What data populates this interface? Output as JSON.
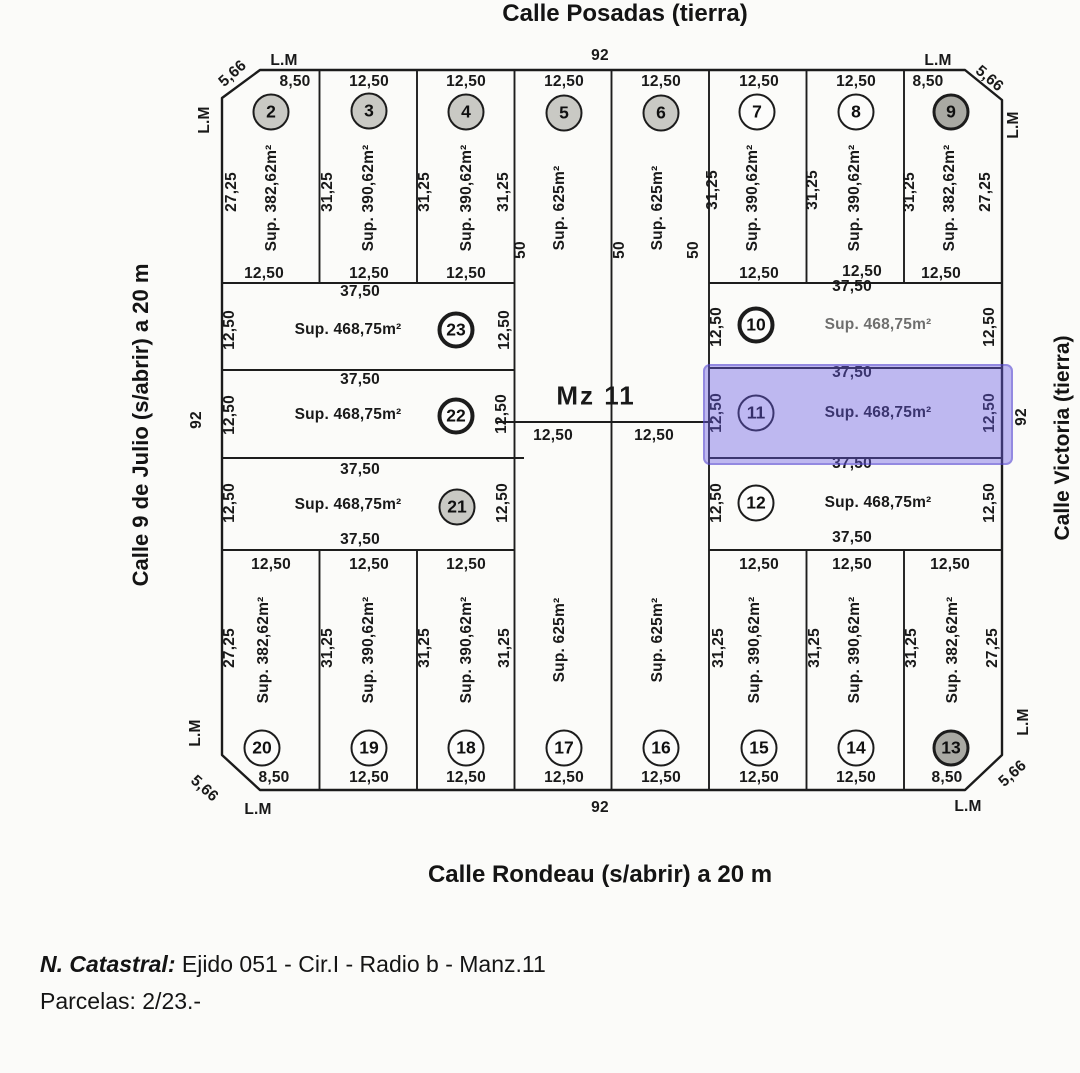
{
  "streets": {
    "top": "Calle Posadas (tierra)",
    "left": "Calle 9 de Julio (s/abrir) a 20 m",
    "right": "Calle Victoria (tierra)",
    "bottom": "Calle Rondeau (s/abrir) a 20 m"
  },
  "notes": {
    "catastral_label": "N. Catastral:",
    "catastral_value": "Ejido 051 - Cir.I - Radio b - Manz.11",
    "parcelas": "Parcelas: 2/23.-"
  },
  "block_label": "Mz 11",
  "colors": {
    "highlight": "#685ae4",
    "line": "#1d1d1d",
    "paper": "#fbfbf9"
  },
  "plan": {
    "outline": "M 260 70 L 965 70 L 1002 100 L 1002 755 L 965 790 L 260 790 L 222 755 L 222 98 Z",
    "lines": [
      [
        319.5,
        70,
        319.5,
        283
      ],
      [
        417,
        70,
        417,
        283
      ],
      [
        806.5,
        70,
        806.5,
        283
      ],
      [
        904,
        70,
        904,
        283
      ],
      [
        319.5,
        550,
        319.5,
        790
      ],
      [
        417,
        550,
        417,
        790
      ],
      [
        806.5,
        550,
        806.5,
        790
      ],
      [
        904,
        550,
        904,
        790
      ],
      [
        514.5,
        70,
        514.5,
        790
      ],
      [
        611.5,
        70,
        611.5,
        790
      ],
      [
        709,
        70,
        709,
        790
      ],
      [
        222,
        283,
        514.5,
        283
      ],
      [
        709,
        283,
        1002,
        283
      ],
      [
        222,
        370,
        514.5,
        370
      ],
      [
        709,
        368,
        1002,
        368
      ],
      [
        222,
        458,
        524,
        458
      ],
      [
        709,
        458,
        1002,
        458
      ],
      [
        222,
        550,
        514.5,
        550
      ],
      [
        709,
        550,
        1002,
        550
      ],
      [
        496,
        422,
        712,
        422
      ]
    ],
    "highlight": {
      "x": 703,
      "y": 364,
      "w": 306,
      "h": 97,
      "parcel": "11"
    },
    "labels": [
      {
        "t": "92",
        "x": 600,
        "y": 56
      },
      {
        "t": "L.M",
        "x": 284,
        "y": 61
      },
      {
        "t": "5,66",
        "x": 233,
        "y": 74,
        "r": -42
      },
      {
        "t": "L.M",
        "x": 205,
        "y": 120,
        "r": -90
      },
      {
        "t": "L.M",
        "x": 938,
        "y": 61
      },
      {
        "t": "5,66",
        "x": 989,
        "y": 79,
        "r": 40
      },
      {
        "t": "L.M",
        "x": 1014,
        "y": 125,
        "r": -90
      },
      {
        "t": "92",
        "x": 197,
        "y": 420,
        "r": -90
      },
      {
        "t": "92",
        "x": 1022,
        "y": 417,
        "r": -90
      },
      {
        "t": "92",
        "x": 600,
        "y": 808
      },
      {
        "t": "L.M",
        "x": 258,
        "y": 810
      },
      {
        "t": "5,66",
        "x": 204,
        "y": 789,
        "r": 42
      },
      {
        "t": "L.M",
        "x": 196,
        "y": 733,
        "r": -90
      },
      {
        "t": "L.M",
        "x": 968,
        "y": 807
      },
      {
        "t": "5,66",
        "x": 1013,
        "y": 774,
        "r": -42
      },
      {
        "t": "L.M",
        "x": 1024,
        "y": 722,
        "r": -90
      },
      {
        "t": "8,50",
        "x": 295,
        "y": 82
      },
      {
        "t": "12,50",
        "x": 369,
        "y": 82
      },
      {
        "t": "12,50",
        "x": 466,
        "y": 82
      },
      {
        "t": "12,50",
        "x": 564,
        "y": 82
      },
      {
        "t": "12,50",
        "x": 661,
        "y": 82
      },
      {
        "t": "12,50",
        "x": 759,
        "y": 82
      },
      {
        "t": "12,50",
        "x": 856,
        "y": 82
      },
      {
        "t": "8,50",
        "x": 928,
        "y": 82
      },
      {
        "t": "12,50",
        "x": 264,
        "y": 274
      },
      {
        "t": "12,50",
        "x": 369,
        "y": 274
      },
      {
        "t": "12,50",
        "x": 466,
        "y": 274
      },
      {
        "t": "12,50",
        "x": 759,
        "y": 274
      },
      {
        "t": "12,50",
        "x": 862,
        "y": 272
      },
      {
        "t": "12,50",
        "x": 941,
        "y": 274
      },
      {
        "t": "27,25",
        "x": 232,
        "y": 192,
        "r": -90
      },
      {
        "t": "31,25",
        "x": 328,
        "y": 192,
        "r": -90
      },
      {
        "t": "31,25",
        "x": 425,
        "y": 192,
        "r": -90
      },
      {
        "t": "31,25",
        "x": 504,
        "y": 192,
        "r": -90
      },
      {
        "t": "31,25",
        "x": 713,
        "y": 190,
        "r": -90
      },
      {
        "t": "31,25",
        "x": 813,
        "y": 190,
        "r": -90
      },
      {
        "t": "31,25",
        "x": 910,
        "y": 192,
        "r": -90
      },
      {
        "t": "27,25",
        "x": 986,
        "y": 192,
        "r": -90
      },
      {
        "t": "50",
        "x": 521,
        "y": 250,
        "r": -90
      },
      {
        "t": "50",
        "x": 620,
        "y": 250,
        "r": -90
      },
      {
        "t": "50",
        "x": 694,
        "y": 250,
        "r": -90
      },
      {
        "t": "37,50",
        "x": 360,
        "y": 292
      },
      {
        "t": "37,50",
        "x": 360,
        "y": 380
      },
      {
        "t": "37,50",
        "x": 360,
        "y": 470
      },
      {
        "t": "37,50",
        "x": 360,
        "y": 540
      },
      {
        "t": "37,50",
        "x": 852,
        "y": 287
      },
      {
        "t": "37,50",
        "x": 852,
        "y": 373
      },
      {
        "t": "37,50",
        "x": 852,
        "y": 464
      },
      {
        "t": "37,50",
        "x": 852,
        "y": 538
      },
      {
        "t": "12,50",
        "x": 230,
        "y": 330,
        "r": -90
      },
      {
        "t": "12,50",
        "x": 505,
        "y": 330,
        "r": -90
      },
      {
        "t": "12,50",
        "x": 230,
        "y": 415,
        "r": -90
      },
      {
        "t": "12,50",
        "x": 502,
        "y": 414,
        "r": -90
      },
      {
        "t": "12,50",
        "x": 230,
        "y": 503,
        "r": -90
      },
      {
        "t": "12,50",
        "x": 503,
        "y": 503,
        "r": -90
      },
      {
        "t": "12,50",
        "x": 717,
        "y": 327,
        "r": -90
      },
      {
        "t": "12,50",
        "x": 990,
        "y": 327,
        "r": -90
      },
      {
        "t": "12,50",
        "x": 717,
        "y": 413,
        "r": -90
      },
      {
        "t": "12,50",
        "x": 990,
        "y": 413,
        "r": -90
      },
      {
        "t": "12,50",
        "x": 717,
        "y": 503,
        "r": -90
      },
      {
        "t": "12,50",
        "x": 990,
        "y": 503,
        "r": -90
      },
      {
        "t": "Mz 11",
        "x": 596,
        "y": 396,
        "s": "lg"
      },
      {
        "t": "12,50",
        "x": 553,
        "y": 436
      },
      {
        "t": "12,50",
        "x": 654,
        "y": 436
      },
      {
        "t": "12,50",
        "x": 271,
        "y": 565
      },
      {
        "t": "12,50",
        "x": 369,
        "y": 565
      },
      {
        "t": "12,50",
        "x": 466,
        "y": 565
      },
      {
        "t": "12,50",
        "x": 759,
        "y": 565
      },
      {
        "t": "12,50",
        "x": 852,
        "y": 565
      },
      {
        "t": "12,50",
        "x": 950,
        "y": 565
      },
      {
        "t": "27,25",
        "x": 230,
        "y": 648,
        "r": -90
      },
      {
        "t": "31,25",
        "x": 328,
        "y": 648,
        "r": -90
      },
      {
        "t": "31,25",
        "x": 425,
        "y": 648,
        "r": -90
      },
      {
        "t": "31,25",
        "x": 505,
        "y": 648,
        "r": -90
      },
      {
        "t": "31,25",
        "x": 719,
        "y": 648,
        "r": -90
      },
      {
        "t": "31,25",
        "x": 815,
        "y": 648,
        "r": -90
      },
      {
        "t": "31,25",
        "x": 912,
        "y": 648,
        "r": -90
      },
      {
        "t": "27,25",
        "x": 993,
        "y": 648,
        "r": -90
      },
      {
        "t": "8,50",
        "x": 274,
        "y": 778
      },
      {
        "t": "12,50",
        "x": 369,
        "y": 778
      },
      {
        "t": "12,50",
        "x": 466,
        "y": 778
      },
      {
        "t": "12,50",
        "x": 564,
        "y": 778
      },
      {
        "t": "12,50",
        "x": 661,
        "y": 778
      },
      {
        "t": "12,50",
        "x": 759,
        "y": 778
      },
      {
        "t": "12,50",
        "x": 856,
        "y": 778
      },
      {
        "t": "8,50",
        "x": 947,
        "y": 778
      }
    ],
    "parcels": [
      {
        "num": "2",
        "cx": 271,
        "cy": 112,
        "style": "gray",
        "sup": {
          "t": "Sup. 382,62m²",
          "x": 272,
          "y": 198,
          "r": -90
        }
      },
      {
        "num": "3",
        "cx": 369,
        "cy": 111,
        "style": "gray",
        "sup": {
          "t": "Sup. 390,62m²",
          "x": 369,
          "y": 198,
          "r": -90
        }
      },
      {
        "num": "4",
        "cx": 466,
        "cy": 112,
        "style": "gray",
        "sup": {
          "t": "Sup. 390,62m²",
          "x": 467,
          "y": 198,
          "r": -90
        }
      },
      {
        "num": "5",
        "cx": 564,
        "cy": 113,
        "style": "gray",
        "sup": {
          "t": "Sup. 625m²",
          "x": 560,
          "y": 208,
          "r": -90
        }
      },
      {
        "num": "6",
        "cx": 661,
        "cy": 113,
        "style": "gray",
        "sup": {
          "t": "Sup. 625m²",
          "x": 658,
          "y": 208,
          "r": -90
        }
      },
      {
        "num": "7",
        "cx": 757,
        "cy": 112,
        "style": "normal",
        "sup": {
          "t": "Sup. 390,62m²",
          "x": 753,
          "y": 198,
          "r": -90
        }
      },
      {
        "num": "8",
        "cx": 856,
        "cy": 112,
        "style": "normal",
        "sup": {
          "t": "Sup. 390,62m²",
          "x": 855,
          "y": 198,
          "r": -90
        }
      },
      {
        "num": "9",
        "cx": 951,
        "cy": 112,
        "style": "dark",
        "sup": {
          "t": "Sup. 382,62m²",
          "x": 950,
          "y": 198,
          "r": -90
        }
      },
      {
        "num": "10",
        "cx": 756,
        "cy": 325,
        "style": "bold",
        "sup": {
          "t": "Sup. 468,75m²",
          "x": 878,
          "y": 325,
          "r": 0,
          "faded": true
        }
      },
      {
        "num": "11",
        "cx": 756,
        "cy": 413,
        "style": "normal",
        "sup": {
          "t": "Sup. 468,75m²",
          "x": 878,
          "y": 413,
          "r": 0
        }
      },
      {
        "num": "12",
        "cx": 756,
        "cy": 503,
        "style": "normal",
        "sup": {
          "t": "Sup. 468,75m²",
          "x": 878,
          "y": 503,
          "r": 0
        }
      },
      {
        "num": "13",
        "cx": 951,
        "cy": 748,
        "style": "dark",
        "sup": {
          "t": "Sup. 382,62m²",
          "x": 953,
          "y": 650,
          "r": -90
        }
      },
      {
        "num": "14",
        "cx": 856,
        "cy": 748,
        "style": "normal",
        "sup": {
          "t": "Sup. 390,62m²",
          "x": 855,
          "y": 650,
          "r": -90
        }
      },
      {
        "num": "15",
        "cx": 759,
        "cy": 748,
        "style": "normal",
        "sup": {
          "t": "Sup. 390,62m²",
          "x": 755,
          "y": 650,
          "r": -90
        }
      },
      {
        "num": "16",
        "cx": 661,
        "cy": 748,
        "style": "normal",
        "sup": {
          "t": "Sup. 625m²",
          "x": 658,
          "y": 640,
          "r": -90
        }
      },
      {
        "num": "17",
        "cx": 564,
        "cy": 748,
        "style": "normal",
        "sup": {
          "t": "Sup. 625m²",
          "x": 560,
          "y": 640,
          "r": -90
        }
      },
      {
        "num": "18",
        "cx": 466,
        "cy": 748,
        "style": "normal",
        "sup": {
          "t": "Sup. 390,62m²",
          "x": 467,
          "y": 650,
          "r": -90
        }
      },
      {
        "num": "19",
        "cx": 369,
        "cy": 748,
        "style": "normal",
        "sup": {
          "t": "Sup. 390,62m²",
          "x": 369,
          "y": 650,
          "r": -90
        }
      },
      {
        "num": "20",
        "cx": 262,
        "cy": 748,
        "style": "normal",
        "sup": {
          "t": "Sup. 382,62m²",
          "x": 264,
          "y": 650,
          "r": -90
        }
      },
      {
        "num": "21",
        "cx": 457,
        "cy": 507,
        "style": "gray",
        "sup": {
          "t": "Sup. 468,75m²",
          "x": 348,
          "y": 505,
          "r": 0
        }
      },
      {
        "num": "22",
        "cx": 456,
        "cy": 416,
        "style": "bold",
        "sup": {
          "t": "Sup. 468,75m²",
          "x": 348,
          "y": 415,
          "r": 0
        }
      },
      {
        "num": "23",
        "cx": 456,
        "cy": 330,
        "style": "bold",
        "sup": {
          "t": "Sup. 468,75m²",
          "x": 348,
          "y": 330,
          "r": 0
        }
      }
    ]
  }
}
